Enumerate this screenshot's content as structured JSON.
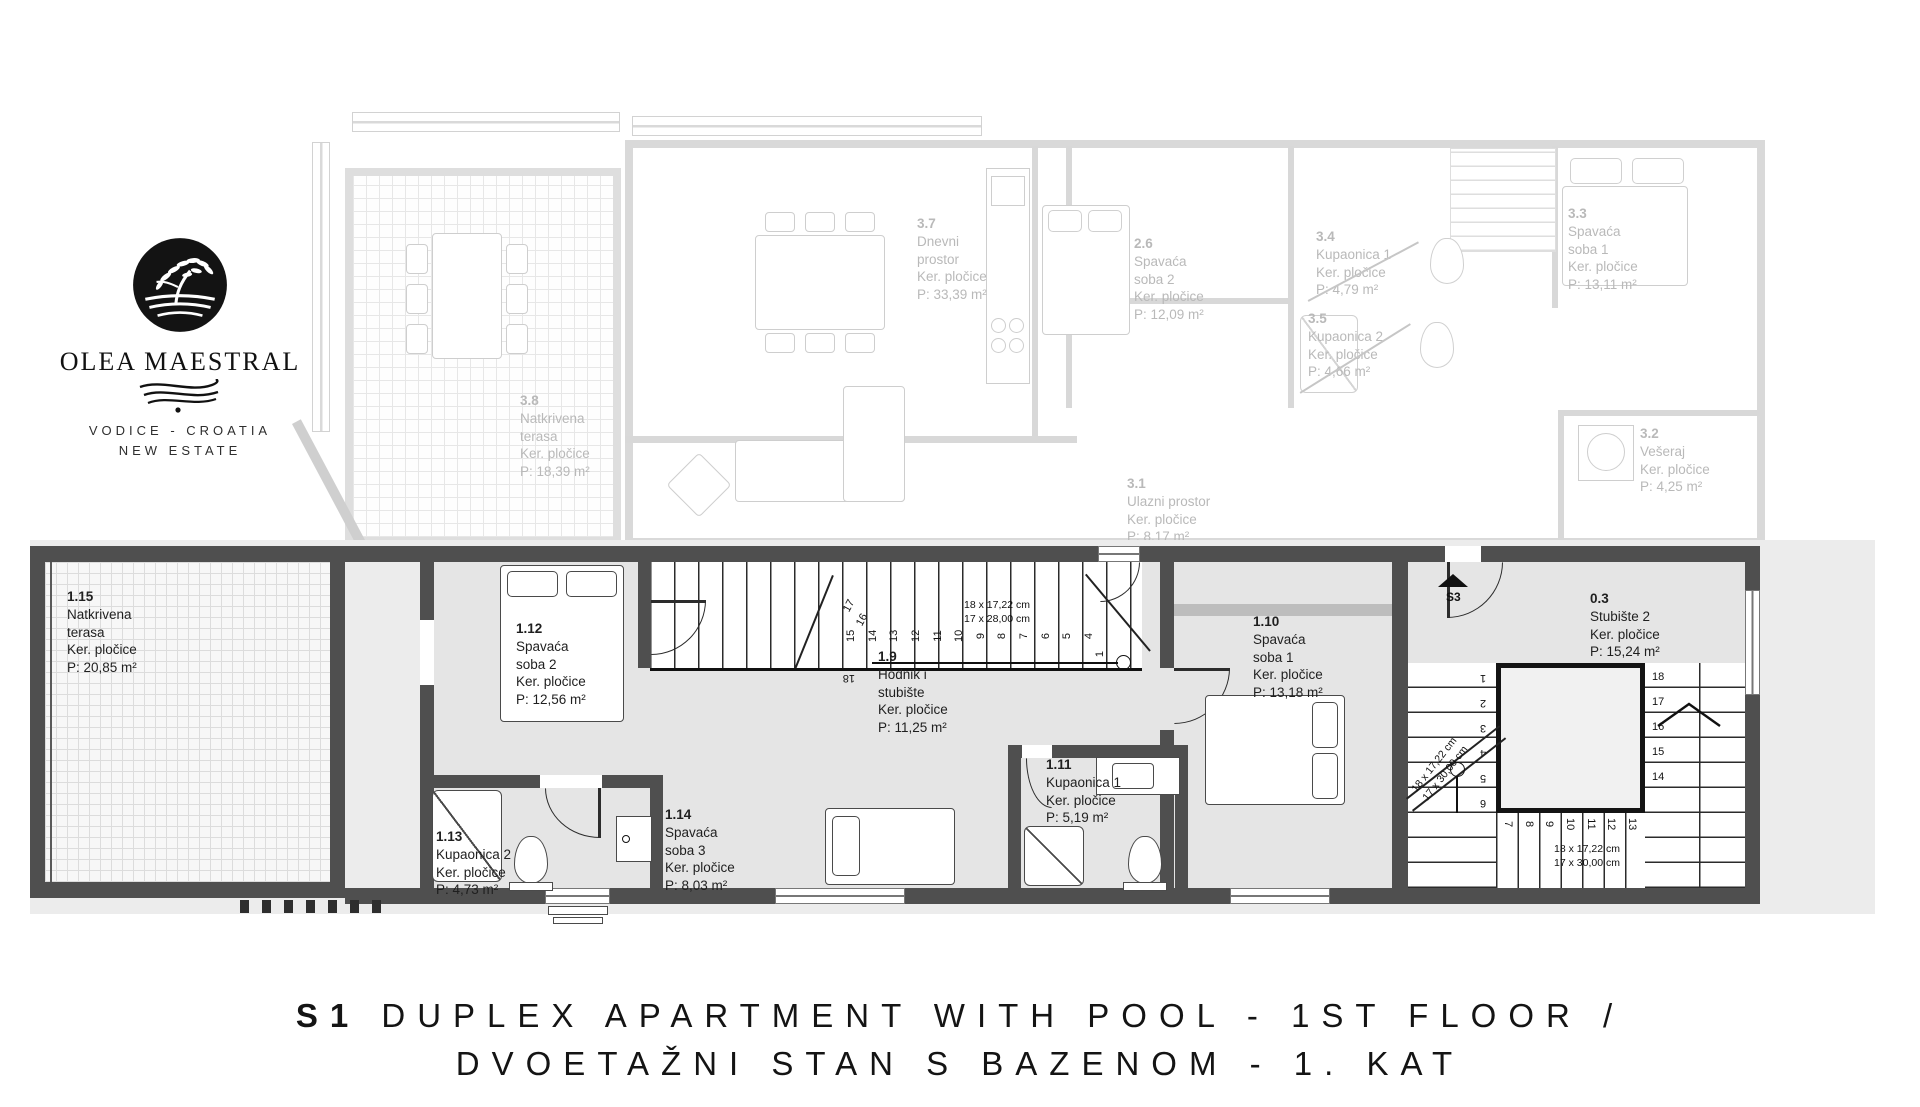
{
  "brand": {
    "name": "OLEA MAESTRAL",
    "location": "VODICE - CROATIA",
    "tagline": "NEW ESTATE"
  },
  "title": {
    "code": "S1",
    "line1": "DUPLEX APARTMENT WITH POOL - 1ST FLOOR /",
    "line2": "DVOETAŽNI STAN S BAZENOM - 1. KAT"
  },
  "rooms": {
    "upper": {
      "r37": {
        "id": "3.7",
        "name": "Dnevni prostor",
        "finish": "Ker. pločice",
        "area": "P: 33,39 m²"
      },
      "r26": {
        "id": "2.6",
        "name": "Spavaća soba 2",
        "finish": "Ker. pločice",
        "area": "P: 12,09 m²"
      },
      "r34": {
        "id": "3.4",
        "name": "Kupaonica 1",
        "finish": "Ker. pločice",
        "area": "P: 4,79 m²"
      },
      "r35": {
        "id": "3.5",
        "name": "Kupaonica 2",
        "finish": "Ker. pločice",
        "area": "P: 4,66 m²"
      },
      "r33": {
        "id": "3.3",
        "name": "Spavaća soba 1",
        "finish": "Ker. pločice",
        "area": "P: 13,11 m²"
      },
      "r38": {
        "id": "3.8",
        "name": "Natkrivena terasa",
        "finish": "Ker. pločice",
        "area": "P: 18,39 m²"
      },
      "r31": {
        "id": "3.1",
        "name": "Ulazni prostor",
        "finish": "Ker. pločice",
        "area": "P: 8,17 m²"
      },
      "r32": {
        "id": "3.2",
        "name": "Vešeraj",
        "finish": "Ker. pločice",
        "area": "P: 4,25 m²"
      }
    },
    "lower": {
      "r115": {
        "id": "1.15",
        "name": "Natkrivena terasa",
        "finish": "Ker. pločice",
        "area": "P: 20,85 m²"
      },
      "r112": {
        "id": "1.12",
        "name": "Spavaća soba 2",
        "finish": "Ker. pločice",
        "area": "P: 12,56 m²"
      },
      "r19": {
        "id": "1.9",
        "name": "Hodnik i stubište",
        "finish": "Ker. pločice",
        "area": "P: 11,25 m²"
      },
      "r110": {
        "id": "1.10",
        "name": "Spavaća soba 1",
        "finish": "Ker. pločice",
        "area": "P: 13,18 m²"
      },
      "r03": {
        "id": "0.3",
        "name": "Stubište 2",
        "finish": "Ker. pločice",
        "area": "P: 15,24 m²"
      },
      "r113": {
        "id": "1.13",
        "name": "Kupaonica 2",
        "finish": "Ker. pločice",
        "area": "P: 4,73 m²"
      },
      "r114": {
        "id": "1.14",
        "name": "Spavaća soba 3",
        "finish": "Ker. pločice",
        "area": "P: 8,03 m²"
      },
      "r111": {
        "id": "1.11",
        "name": "Kupaonica 1",
        "finish": "Ker. pločice",
        "area": "P: 5,19 m²"
      }
    }
  },
  "stairs": {
    "run19": {
      "dim1": "18 x 17,22 cm",
      "dim2": "17 x 28,00 cm",
      "numbers": [
        "15",
        "14",
        "13",
        "12",
        "11",
        "10",
        "9",
        "8",
        "7",
        "6",
        "5",
        "4"
      ],
      "side": [
        "17",
        "16",
        "18"
      ],
      "first": "1"
    },
    "stair03": {
      "dim1": "18 x 17,22 cm",
      "dim2": "17 x 30,00 cm",
      "right": [
        "18",
        "17",
        "16",
        "15",
        "14"
      ],
      "bottom": [
        "7",
        "8",
        "9",
        "10",
        "11",
        "12",
        "13"
      ],
      "left": [
        "1",
        "2",
        "3",
        "4",
        "5",
        "6"
      ],
      "marker": "S3"
    }
  },
  "colors": {
    "wall": "#4f4f4f",
    "ghost_wall": "#d8d8d8",
    "backdrop": "#ececec",
    "room_fill": "#e5e5e5",
    "ink": "#141414"
  }
}
